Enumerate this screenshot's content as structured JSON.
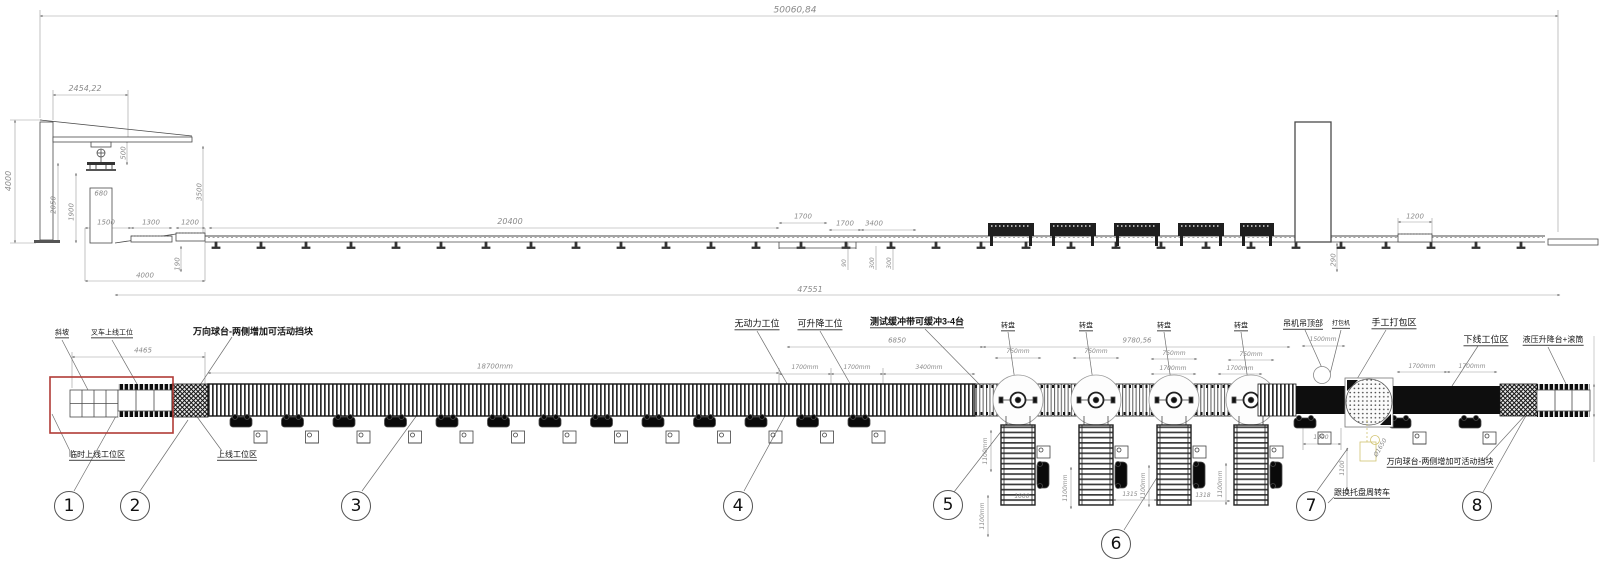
{
  "drawing": {
    "type": "production-line layout drawing",
    "views": [
      "elevation",
      "plan"
    ]
  },
  "colors": {
    "line": "#4a4a4a",
    "dim_text": "#8a8a8a",
    "label_text": "#141414",
    "highlight_red": "#b03b36",
    "highlight_yellow": "#c9b958",
    "belt_black": "#0e0e0e"
  },
  "elevation": {
    "dims": [
      {
        "t": "50060,84",
        "x": 795,
        "y": 11,
        "s": 9
      },
      {
        "t": "2454,22",
        "x": 85,
        "y": 89,
        "s": 8
      },
      {
        "t": "4000",
        "x": 9,
        "y": 181,
        "s": 8,
        "r": -90
      },
      {
        "t": "2050",
        "x": 54,
        "y": 205,
        "s": 7,
        "r": -90
      },
      {
        "t": "1900",
        "x": 72,
        "y": 212,
        "s": 7,
        "r": -90
      },
      {
        "t": "500",
        "x": 124,
        "y": 153,
        "s": 7,
        "r": -90
      },
      {
        "t": "3500",
        "x": 200,
        "y": 192,
        "s": 7,
        "r": -90
      },
      {
        "t": "680",
        "x": 101,
        "y": 194,
        "s": 7
      },
      {
        "t": "1500",
        "x": 106,
        "y": 223,
        "s": 7
      },
      {
        "t": "1300",
        "x": 151,
        "y": 223,
        "s": 7
      },
      {
        "t": "1200",
        "x": 190,
        "y": 223,
        "s": 7
      },
      {
        "t": "190",
        "x": 178,
        "y": 264,
        "s": 7,
        "r": -90
      },
      {
        "t": "4000",
        "x": 145,
        "y": 276,
        "s": 7
      },
      {
        "t": "20400",
        "x": 510,
        "y": 222,
        "s": 8
      },
      {
        "t": "1700",
        "x": 803,
        "y": 217,
        "s": 7
      },
      {
        "t": "1700",
        "x": 845,
        "y": 224,
        "s": 7
      },
      {
        "t": "3400",
        "x": 874,
        "y": 224,
        "s": 7
      },
      {
        "t": "90",
        "x": 845,
        "y": 263,
        "s": 6,
        "r": -90
      },
      {
        "t": "300",
        "x": 873,
        "y": 263,
        "s": 6,
        "r": -90
      },
      {
        "t": "300",
        "x": 890,
        "y": 263,
        "s": 6,
        "r": -90
      },
      {
        "t": "290",
        "x": 1334,
        "y": 260,
        "s": 7,
        "r": -90
      },
      {
        "t": "1200",
        "x": 1415,
        "y": 217,
        "s": 7
      },
      {
        "t": "47551",
        "x": 810,
        "y": 290,
        "s": 8
      }
    ]
  },
  "plan": {
    "labels": [
      {
        "t": "斜坡",
        "x": 62,
        "y": 334,
        "s": 7,
        "u": 1
      },
      {
        "t": "叉车上线工位",
        "x": 112,
        "y": 334,
        "s": 7,
        "u": 1
      },
      {
        "t": "万向球台-两侧增加可活动挡块",
        "x": 253,
        "y": 332,
        "s": 9,
        "b": 1
      },
      {
        "t": "无动力工位",
        "x": 757,
        "y": 325,
        "s": 9,
        "u": 1
      },
      {
        "t": "可升降工位",
        "x": 820,
        "y": 325,
        "s": 9,
        "u": 1
      },
      {
        "t": "测试缓冲带可缓冲3-4台",
        "x": 917,
        "y": 323,
        "s": 9,
        "b": 1,
        "u": 1
      },
      {
        "t": "转盘",
        "x": 1008,
        "y": 327,
        "s": 7,
        "u": 1
      },
      {
        "t": "转盘",
        "x": 1086,
        "y": 327,
        "s": 7,
        "u": 1
      },
      {
        "t": "转盘",
        "x": 1164,
        "y": 327,
        "s": 7,
        "u": 1
      },
      {
        "t": "转盘",
        "x": 1241,
        "y": 327,
        "s": 7,
        "u": 1
      },
      {
        "t": "吊机吊顶部",
        "x": 1303,
        "y": 325,
        "s": 8,
        "u": 1
      },
      {
        "t": "打包机",
        "x": 1341,
        "y": 325,
        "s": 6,
        "u": 1
      },
      {
        "t": "手工打包区",
        "x": 1394,
        "y": 324,
        "s": 9,
        "u": 1
      },
      {
        "t": "下线工位区",
        "x": 1486,
        "y": 341,
        "s": 9,
        "u": 1
      },
      {
        "t": "液压升降台+滚筒",
        "x": 1553,
        "y": 341,
        "s": 8,
        "u": 1
      },
      {
        "t": "临时上线工位区",
        "x": 97,
        "y": 456,
        "s": 8,
        "u": 1
      },
      {
        "t": "上线工位区",
        "x": 237,
        "y": 456,
        "s": 8,
        "u": 1
      },
      {
        "t": "万向球台-两侧增加可活动挡块",
        "x": 1440,
        "y": 463,
        "s": 8,
        "u": 1
      },
      {
        "t": "跟换托盘周转车",
        "x": 1362,
        "y": 494,
        "s": 8,
        "u": 1
      }
    ],
    "dims": [
      {
        "t": "4465",
        "x": 143,
        "y": 351,
        "s": 7
      },
      {
        "t": "18700mm",
        "x": 495,
        "y": 367,
        "s": 7
      },
      {
        "t": "6850",
        "x": 897,
        "y": 341,
        "s": 7
      },
      {
        "t": "1700mm",
        "x": 805,
        "y": 368,
        "s": 6
      },
      {
        "t": "1700mm",
        "x": 857,
        "y": 368,
        "s": 6
      },
      {
        "t": "3400mm",
        "x": 929,
        "y": 368,
        "s": 6
      },
      {
        "t": "9780,56",
        "x": 1137,
        "y": 341,
        "s": 7
      },
      {
        "t": "750mm",
        "x": 1018,
        "y": 352,
        "s": 6
      },
      {
        "t": "750mm",
        "x": 1096,
        "y": 352,
        "s": 6
      },
      {
        "t": "750mm",
        "x": 1174,
        "y": 354,
        "s": 6
      },
      {
        "t": "750mm",
        "x": 1251,
        "y": 355,
        "s": 6
      },
      {
        "t": "1700mm",
        "x": 1173,
        "y": 369,
        "s": 6
      },
      {
        "t": "1700mm",
        "x": 1240,
        "y": 369,
        "s": 6
      },
      {
        "t": "1500mm",
        "x": 1323,
        "y": 340,
        "s": 6
      },
      {
        "t": "1700mm",
        "x": 1422,
        "y": 367,
        "s": 6
      },
      {
        "t": "1700mm",
        "x": 1472,
        "y": 367,
        "s": 6
      },
      {
        "t": "1100",
        "x": 1321,
        "y": 438,
        "s": 6
      },
      {
        "t": "1100",
        "x": 1343,
        "y": 468,
        "s": 6,
        "r": -90
      },
      {
        "t": "Ø1650",
        "x": 1381,
        "y": 448,
        "s": 6,
        "r": -60
      },
      {
        "t": "1100mm",
        "x": 986,
        "y": 451,
        "s": 6,
        "r": -90
      },
      {
        "t": "1100mm",
        "x": 983,
        "y": 516,
        "s": 6,
        "r": -90
      },
      {
        "t": "1100mm",
        "x": 1066,
        "y": 488,
        "s": 6,
        "r": -90
      },
      {
        "t": "1100mm",
        "x": 1144,
        "y": 486,
        "s": 6,
        "r": -90
      },
      {
        "t": "1100mm",
        "x": 1221,
        "y": 484,
        "s": 6,
        "r": -90
      },
      {
        "t": "1000",
        "x": 1022,
        "y": 497,
        "s": 6
      },
      {
        "t": "1315",
        "x": 1130,
        "y": 495,
        "s": 6
      },
      {
        "t": "1318",
        "x": 1203,
        "y": 496,
        "s": 6
      }
    ]
  },
  "balloons": [
    {
      "n": "1",
      "x": 69,
      "y": 506
    },
    {
      "n": "2",
      "x": 135,
      "y": 506
    },
    {
      "n": "3",
      "x": 356,
      "y": 506
    },
    {
      "n": "4",
      "x": 738,
      "y": 506
    },
    {
      "n": "5",
      "x": 948,
      "y": 505
    },
    {
      "n": "6",
      "x": 1116,
      "y": 544
    },
    {
      "n": "7",
      "x": 1311,
      "y": 506
    },
    {
      "n": "8",
      "x": 1477,
      "y": 506
    }
  ]
}
